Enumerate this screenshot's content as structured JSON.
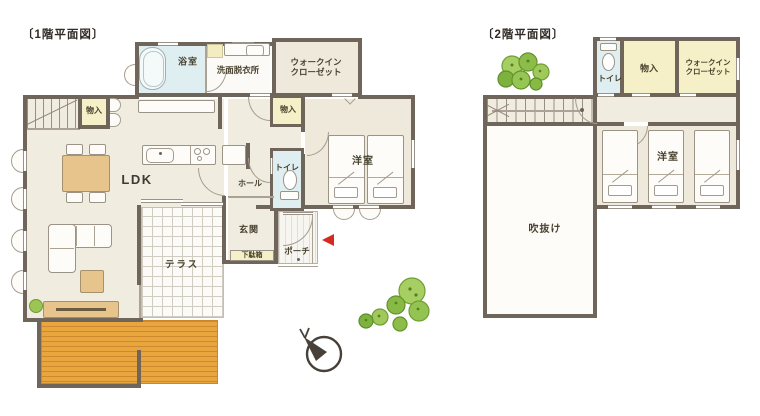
{
  "floor1": {
    "title": "〔1階平面図〕",
    "rooms": {
      "bathroom": "浴室",
      "washroom": "洗面脱衣所",
      "wic_line1": "ウォークイン",
      "wic_line2": "クローゼット",
      "storage_a": "物入",
      "storage_b": "物入",
      "ldk": "LDK",
      "hall": "ホール",
      "toilet": "トイレ",
      "bedroom": "洋室",
      "entrance": "玄関",
      "shoe_cabinet": "下駄箱",
      "porch": "ポーチ",
      "terrace": "テラス"
    }
  },
  "floor2": {
    "title": "〔2階平面図〕",
    "rooms": {
      "toilet": "トイレ",
      "storage": "物入",
      "wic_line1": "ウォークイン",
      "wic_line2": "クローゼット",
      "bedroom": "洋室",
      "void": "吹抜け"
    }
  },
  "colors": {
    "wall": "#6f655a",
    "water_room_blue": "#dfeef0",
    "floor_cream": "#f1ece0",
    "storage_yellow": "#f6f0c8",
    "deck_orange": "#e9a53e",
    "tree_green": "#8cbd49",
    "entrance_arrow_red": "#d42a20"
  },
  "icons": {
    "compass": "north-compass",
    "entrance_marker": "red-left-arrow",
    "trees": "garden-trees"
  }
}
